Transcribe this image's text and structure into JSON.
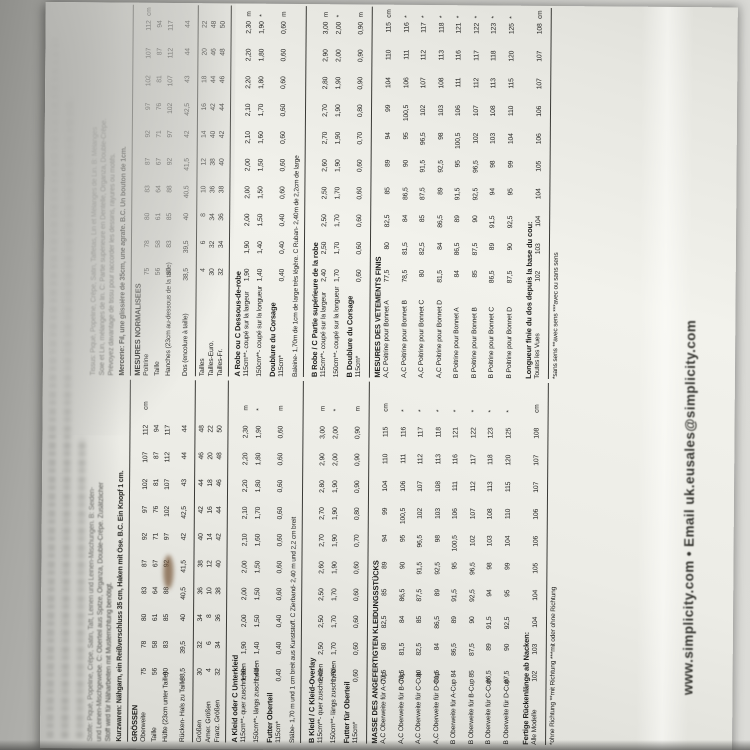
{
  "colors": {
    "background_grey": "#c9c9c5",
    "paper": "#eeeee8",
    "ink": "#1d1d1b",
    "stain_brown": "#7a5a3c"
  },
  "shared": {
    "bust": [
      "75",
      "78",
      "80",
      "83",
      "87",
      "92",
      "97",
      "102",
      "107",
      "112"
    ],
    "waist": [
      "56",
      "58",
      "61",
      "64",
      "67",
      "71",
      "76",
      "81",
      "87",
      "94"
    ],
    "hip": [
      "80",
      "83",
      "85",
      "88",
      "92",
      "97",
      "102",
      "107",
      "112",
      "117"
    ],
    "back": [
      "38,5",
      "39,5",
      "40",
      "40,5",
      "41,5",
      "42",
      "42,5",
      "43",
      "44",
      "44"
    ],
    "sizes_eur": [
      "30",
      "32",
      "34",
      "36",
      "38",
      "40",
      "42",
      "44",
      "46",
      "48"
    ],
    "sizes_us": [
      "4",
      "6",
      "8",
      "10",
      "12",
      "14",
      "16",
      "18",
      "20",
      "22"
    ],
    "sizes_fr": [
      "32",
      "34",
      "36",
      "38",
      "40",
      "42",
      "44",
      "46",
      "48",
      "50"
    ],
    "a_115": [
      "1,90",
      "1,90",
      "2,00",
      "2,00",
      "2,00",
      "2,10",
      "2,10",
      "2,20",
      "2,20",
      "2,30"
    ],
    "a_150": [
      "1,40",
      "1,40",
      "1,50",
      "1,50",
      "1,50",
      "1,60",
      "1,70",
      "1,80",
      "1,80",
      "1,90"
    ],
    "a_lining": [
      "0,40",
      "0,40",
      "0,40",
      "0,60",
      "0,60",
      "0,60",
      "0,60",
      "0,60",
      "0,60",
      "0,60"
    ],
    "b_115": [
      "2,40",
      "2,50",
      "2,50",
      "2,50",
      "2,60",
      "2,70",
      "2,70",
      "2,80",
      "2,90",
      "3,00"
    ],
    "b_150": [
      "1,70",
      "1,70",
      "1,70",
      "1,70",
      "1,90",
      "1,90",
      "1,90",
      "1,90",
      "2,00",
      "2,00"
    ],
    "b_lining": [
      "0,60",
      "0,60",
      "0,60",
      "0,60",
      "0,60",
      "0,70",
      "0,80",
      "0,90",
      "0,90",
      "0,90"
    ],
    "fin_ac_a": [
      "77,5",
      "80",
      "82,5",
      "85",
      "89",
      "94",
      "99",
      "104",
      "110",
      "115"
    ],
    "fin_ac_b": [
      "78,5",
      "81,5",
      "84",
      "86,5",
      "90",
      "95",
      "100,5",
      "106",
      "111",
      "116"
    ],
    "fin_ac_c": [
      "80",
      "82,5",
      "85",
      "87,5",
      "91,5",
      "96,5",
      "102",
      "107",
      "112",
      "117"
    ],
    "fin_ac_d": [
      "81,5",
      "84",
      "86,5",
      "89",
      "92,5",
      "98",
      "103",
      "108",
      "113",
      "118"
    ],
    "fin_b_a": [
      "84",
      "86,5",
      "89",
      "91,5",
      "95",
      "100,5",
      "106",
      "111",
      "116",
      "121"
    ],
    "fin_b_b": [
      "85",
      "87,5",
      "90",
      "92,5",
      "96,5",
      "102",
      "107",
      "112",
      "117",
      "122"
    ],
    "fin_b_c": [
      "86,5",
      "89",
      "91,5",
      "94",
      "98",
      "103",
      "108",
      "113",
      "118",
      "123"
    ],
    "fin_b_d": [
      "87,5",
      "90",
      "92,5",
      "95",
      "99",
      "104",
      "110",
      "115",
      "120",
      "125"
    ],
    "back_length": [
      "102",
      "103",
      "104",
      "104",
      "105",
      "106",
      "106",
      "107",
      "107",
      "108"
    ]
  },
  "german": {
    "fabric_lines": [
      "Stoffe: Piqué, Popeline, Crêpe, Satin, Taft, Leinen und Leinen-Mischungen. B: Seiden-",
      "und Leinen-Mischgewebe. C: Oberteil aus Spitze, Organza, Double-Crêpe. Zusätzlicher",
      "Stoff wird für Näharbeiten mit Musterrichtung benötigt."
    ],
    "notions": "Kurzwaren: Nähgarn, ein Reißverschluss 35 cm, Haken mit Öse. B.C. Ein Knopf 1 cm.",
    "size_heading": "GRÖSSEN",
    "meas_rows": [
      {
        "label": "Oberweite",
        "key": "bust",
        "unit": "cm"
      },
      {
        "label": "Taille",
        "key": "waist",
        "unit": ""
      },
      {
        "label": "Hüfte (23cm unter Taille)",
        "key": "hip",
        "unit": ""
      },
      {
        "label": "Rücken- Hals zu Taille",
        "key": "back",
        "unit": ""
      }
    ],
    "size_rows": [
      {
        "label": "Größen",
        "key": "sizes_eur"
      },
      {
        "label": "Amer. Größen",
        "key": "sizes_us"
      },
      {
        "label": "Franz. Größen",
        "key": "sizes_fr"
      }
    ],
    "yardage_a_heading": "A Kleid oder C Unterkleid",
    "yardage_a_rows": [
      {
        "label": "115cm**- quer zuschneiden",
        "key": "a_115",
        "unit": "m"
      },
      {
        "label": "150cm**- längs zuschneiden",
        "key": "a_150",
        "unit": "*"
      }
    ],
    "lining_a_heading": "Futter Oberteil",
    "lining_a_rows": [
      {
        "label": "115cm*",
        "key": "a_lining",
        "unit": "m"
      }
    ],
    "notions_note": "Stäbe- 1,70 m und 1 cm breit aus Kunststoff. C Zierband- 2,40 m und 2,2 cm breit",
    "yardage_b_heading": "B Kleid / C Kleid-Overlay",
    "yardage_b_rows": [
      {
        "label": "115cm**- quer zuschneiden",
        "key": "b_115",
        "unit": "m"
      },
      {
        "label": "150cm**- längs zuschneiden",
        "key": "b_150",
        "unit": "*"
      }
    ],
    "lining_b_heading": "Futter für Oberteil",
    "lining_b_rows": [
      {
        "label": "115cm*",
        "key": "b_lining",
        "unit": "m"
      }
    ],
    "finished_heading": "MASSE DES ANGEFERTIGTEN KLEIDUNGSSTÜCKS",
    "finished_rows": [
      {
        "label": "A,C Oberweite für A-Cup",
        "key": "fin_ac_a",
        "unit": "cm"
      },
      {
        "label": "A,C Oberweite für B-Cup",
        "key": "fin_ac_b",
        "unit": "*"
      },
      {
        "label": "A,C Oberweite für C-Cup",
        "key": "fin_ac_c",
        "unit": "*"
      },
      {
        "label": "A,C Oberweite für D-Cup",
        "key": "fin_ac_d",
        "unit": "*"
      },
      {
        "label": "B Oberweite für A-Cup",
        "key": "fin_b_a",
        "unit": "*"
      },
      {
        "label": "B Oberweite für B-Cup",
        "key": "fin_b_b",
        "unit": "*"
      },
      {
        "label": "B Oberweite für C-Cup",
        "key": "fin_b_c",
        "unit": "*"
      },
      {
        "label": "B Oberweite für D-Cup",
        "key": "fin_b_d",
        "unit": "*"
      }
    ],
    "back_length_label": "Fertige Rückenlänge ab Nacken:",
    "back_length_row": {
      "label": "Alle Modelle",
      "key": "back_length",
      "unit": "cm"
    },
    "footnote": "*ohne Richtung   **mit Richtung   ***mit oder ohne Richtung"
  },
  "french": {
    "fabric_lines": [
      "Tissus: Piqué, Popeline, Crêpe, Satin, Taffetas, Lin et Mélanges de Lin. B: Mélanges",
      "Soie et Lin, mélanges de lin. C: Partie supérieure en Dentelle, Organza, Double-Crêpe.",
      "Prévoyez davantage de tissu pour raccorder les dessins, rayures ou motifs."
    ],
    "notions": "Mercerie: Fil, une glissière de 35cm, une agrafe. B.C. Un bouton de 1cm.",
    "size_heading": "MESURES NORMALISEES",
    "meas_rows": [
      {
        "label": "Poitrine",
        "key": "bust",
        "unit": "cm"
      },
      {
        "label": "Taille",
        "key": "waist",
        "unit": ""
      },
      {
        "label": "Hanches (23cm au-dessous de la taille)",
        "key": "hip",
        "unit": ""
      },
      {
        "label": "Dos (encolure à taille)",
        "key": "back",
        "unit": ""
      }
    ],
    "size_rows": [
      {
        "label": "Tailles",
        "key": "sizes_us"
      },
      {
        "label": "Tailles-Euro.",
        "key": "sizes_eur"
      },
      {
        "label": "Tailles-Fr.",
        "key": "sizes_fr"
      }
    ],
    "yardage_a_heading": "A Robe ou C Dessous-de-robe",
    "yardage_a_rows": [
      {
        "label": "115cm**- coupé sur la largeur",
        "key": "a_115",
        "unit": "m"
      },
      {
        "label": "150cm**- coupé sur la longueur",
        "key": "a_150",
        "unit": "*"
      }
    ],
    "lining_a_heading": "Doublure du Corsage",
    "lining_a_rows": [
      {
        "label": "115cm*",
        "key": "a_lining",
        "unit": "m"
      }
    ],
    "notions_note": "Baleine- 1,70m de 1cm de large très légère. C Ruban- 2,40m de 2,2cm de large",
    "yardage_b_heading": "B Robe / C Partie supérieure de la robe",
    "yardage_b_rows": [
      {
        "label": "115cm**- coupé sur la largeur",
        "key": "b_115",
        "unit": "m"
      },
      {
        "label": "150cm**- coupé sur la longueur",
        "key": "b_150",
        "unit": "*"
      }
    ],
    "lining_b_heading": "B Doublure du Corsage",
    "lining_b_rows": [
      {
        "label": "115cm*",
        "key": "b_lining",
        "unit": "m"
      }
    ],
    "finished_heading": "MESURES DES VETEMENTS FINIS",
    "finished_rows": [
      {
        "label": "A,C Poitrine pour Bonnet A",
        "key": "fin_ac_a",
        "unit": "cm"
      },
      {
        "label": "A,C Poitrine pour Bonnet B",
        "key": "fin_ac_b",
        "unit": "*"
      },
      {
        "label": "A,C Poitrine pour Bonnet C",
        "key": "fin_ac_c",
        "unit": "*"
      },
      {
        "label": "A,C Poitrine pour Bonnet D",
        "key": "fin_ac_d",
        "unit": "*"
      },
      {
        "label": "B Poitrine pour Bonnet A",
        "key": "fin_b_a",
        "unit": "*"
      },
      {
        "label": "B Poitrine pour Bonnet B",
        "key": "fin_b_b",
        "unit": "*"
      },
      {
        "label": "B Poitrine pour Bonnet C",
        "key": "fin_b_c",
        "unit": "*"
      },
      {
        "label": "B Poitrine pour Bonnet D",
        "key": "fin_b_d",
        "unit": "*"
      }
    ],
    "back_length_label": "Longueur finie du dos depuis la base du cou:",
    "back_length_row": {
      "label": "Toutes les Vues",
      "key": "back_length",
      "unit": "cm"
    },
    "footnote": "*sans sens   **avec sens   ***avec ou sans sens"
  },
  "footer": {
    "website_line": "www.simplicity.com • Email uk.eusales@simplicity.com"
  }
}
